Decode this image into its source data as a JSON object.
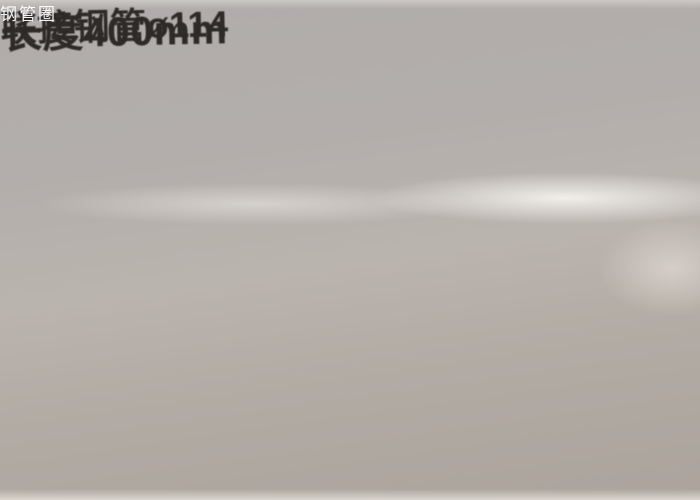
{
  "callout": {
    "line1": "联接钢管ø114",
    "line2": "长度400mm"
  },
  "watermark": {
    "text": "钢管圈"
  },
  "colors": {
    "paper": "#b2adaa",
    "ink": "#2e2a27",
    "sleeve_outline": "#272320",
    "watermark_text": "#ffffff"
  }
}
